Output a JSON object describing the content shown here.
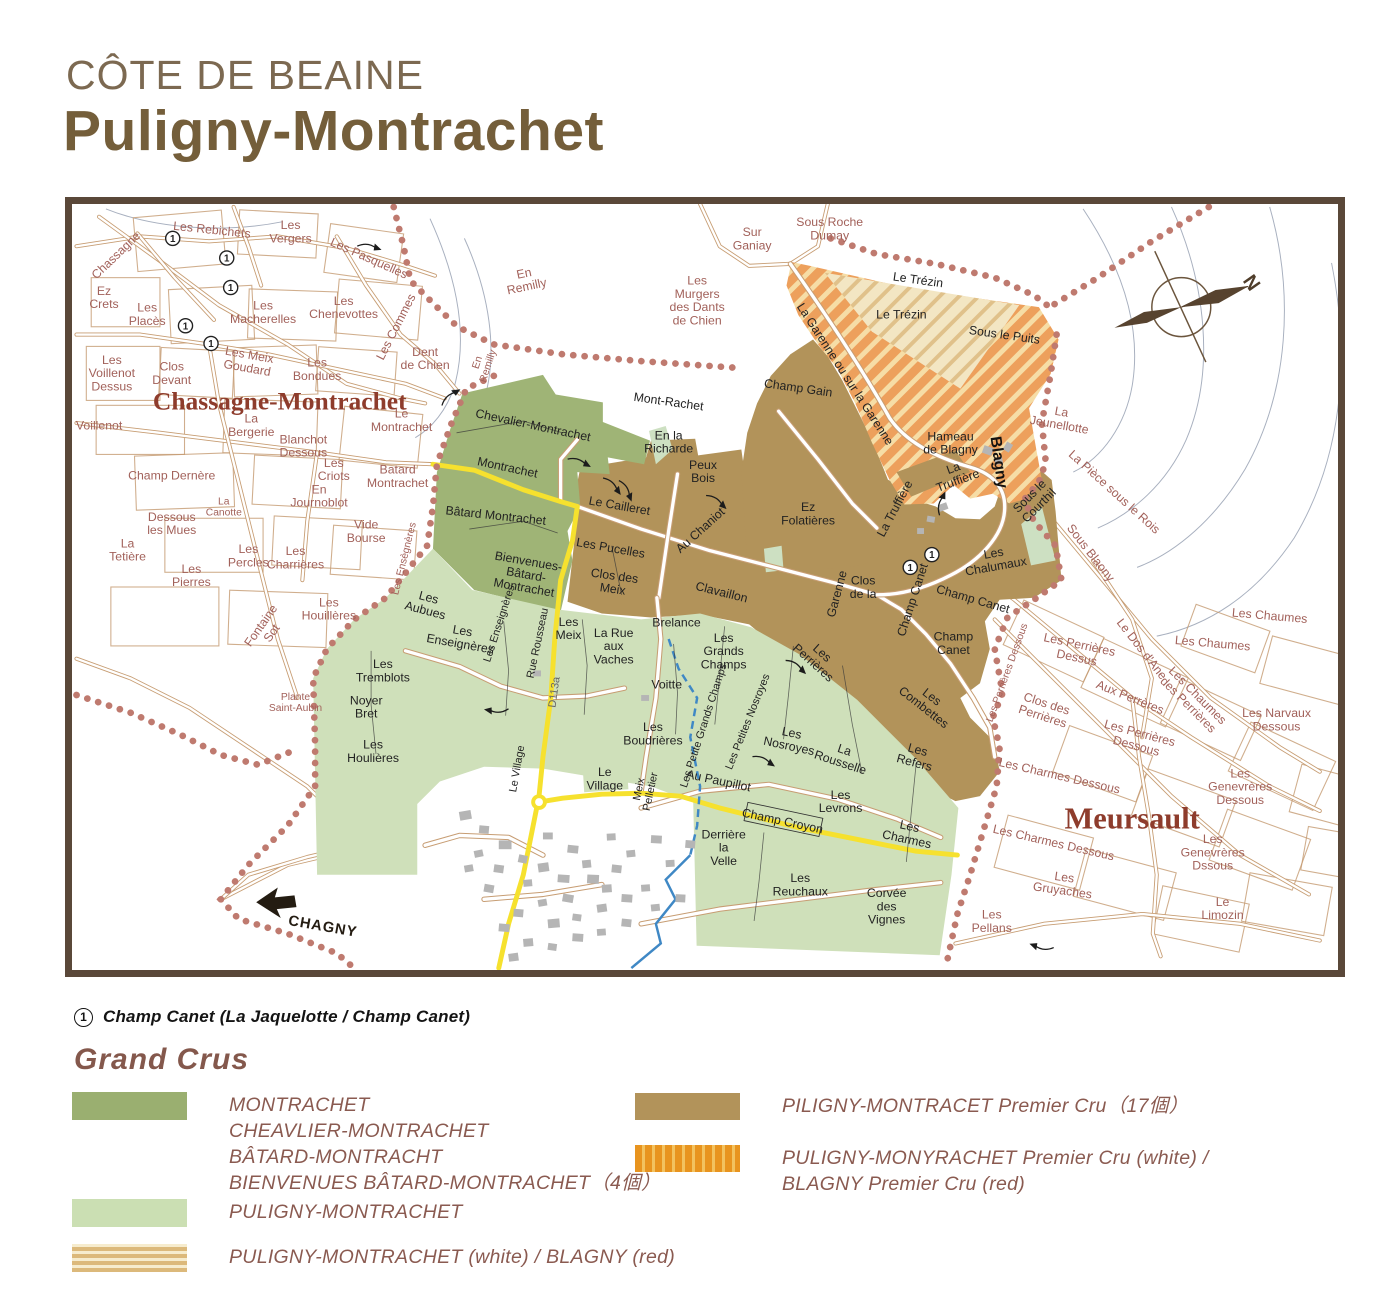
{
  "title": {
    "region": "CÔTE DE BEAINE",
    "name": "Puligny-Montrachet"
  },
  "footnote": {
    "marker": "1",
    "text": "Champ Canet (La Jaquelotte / Champ Canet)"
  },
  "legend": {
    "heading": "Grand Crus",
    "items_left": [
      {
        "swatch": "sw-grand-cru",
        "top": 1092,
        "lines": [
          "MONTRACHET",
          "CHEAVLIER-MONTRACHET",
          "BÂTARD-MONTRACHT",
          "BIENVENUES BÂTARD-MONTRACHET（4個）"
        ]
      },
      {
        "swatch": "sw-village",
        "top": 1199,
        "lines": [
          "PULIGNY-MONTRACHET"
        ]
      },
      {
        "swatch": "sw-stripe-h",
        "top": 1244,
        "lines": [
          "PULIGNY-MONTRACHET (white) / BLAGNY (red)"
        ]
      }
    ],
    "items_right": [
      {
        "swatch": "sw-premier-cru",
        "top": 1093,
        "lines": [
          "PILIGNY-MONTRACET Premier Cru（17個）"
        ]
      },
      {
        "swatch": "sw-stripe-v",
        "top": 1145,
        "lines": [
          "PULIGNY-MONYRACHET Premier Cru (white) /",
          "BLAGNY  Premier Cru (red)"
        ]
      }
    ]
  },
  "colors": {
    "grand_cru_green": "#9fb476",
    "village_green": "#cfe0ba",
    "premier_cru_brown": "#b2935a",
    "blagny_orange": "#eda05c",
    "trezin_cream": "#f3e6c3",
    "boundary_dots": "#bf7a6f",
    "road_tan": "#c79d73",
    "road_yellow": "#f6e12e",
    "stream_blue": "#3f88c5",
    "label_rose": "#a2615a",
    "label_maroon": "#8e3c2c",
    "title_brown": "#745e3a",
    "frame_brown": "#5a4839"
  },
  "map": {
    "compass_label": "N",
    "labels": [
      {
        "t": "Chassagne",
        "x": 40,
        "y": 52,
        "c": "rose",
        "r": -44
      },
      {
        "t": "Les Rebichets",
        "x": 138,
        "y": 26,
        "c": "rose",
        "r": 6
      },
      {
        "t": "Les\nVergers",
        "x": 218,
        "y": 28,
        "c": "rose"
      },
      {
        "t": "Les Pasquelles",
        "x": 298,
        "y": 55,
        "c": "rose",
        "r": 24
      },
      {
        "t": "Ez\nCrets",
        "x": 28,
        "y": 95,
        "c": "rose"
      },
      {
        "t": "Les\nPlacès",
        "x": 72,
        "y": 112,
        "c": "rose"
      },
      {
        "t": "Les\nMacherelles",
        "x": 190,
        "y": 110,
        "c": "rose"
      },
      {
        "t": "Les\nChenevottes",
        "x": 272,
        "y": 105,
        "c": "rose"
      },
      {
        "t": "Les Commes",
        "x": 325,
        "y": 125,
        "c": "rose",
        "r": -63
      },
      {
        "t": "Les\nVoillenot\nDessus",
        "x": 36,
        "y": 172,
        "c": "rose"
      },
      {
        "t": "Clos\nDevant",
        "x": 97,
        "y": 172,
        "c": "rose"
      },
      {
        "t": "Les  Meix\nGoudard",
        "x": 175,
        "y": 160,
        "c": "rose",
        "r": 10
      },
      {
        "t": "Les\nBondues",
        "x": 245,
        "y": 168,
        "c": "rose"
      },
      {
        "t": "Dent\nde Chien",
        "x": 355,
        "y": 157,
        "c": "rose"
      },
      {
        "t": "En\nRemilly",
        "x": 413,
        "y": 163,
        "c": "rose-sm",
        "r": -72
      },
      {
        "t": "En\nRemilly",
        "x": 457,
        "y": 77,
        "c": "rose",
        "r": -12
      },
      {
        "t": "Chassagne-Montrachet",
        "x": 207,
        "y": 200,
        "c": "big"
      },
      {
        "t": "Voillenot",
        "x": 23,
        "y": 225,
        "c": "rose"
      },
      {
        "t": "La\nBergerie",
        "x": 178,
        "y": 225,
        "c": "rose"
      },
      {
        "t": "Blanchot\nDessous",
        "x": 231,
        "y": 246,
        "c": "rose"
      },
      {
        "t": "Le\nMontrachet",
        "x": 331,
        "y": 220,
        "c": "rose"
      },
      {
        "t": "Champ Dernère",
        "x": 97,
        "y": 276,
        "c": "rose"
      },
      {
        "t": "Les\nCriots",
        "x": 262,
        "y": 270,
        "c": "rose"
      },
      {
        "t": "Batard\nMontrachet",
        "x": 327,
        "y": 277,
        "c": "rose"
      },
      {
        "t": "En\nJournoblot",
        "x": 247,
        "y": 297,
        "c": "rose"
      },
      {
        "t": "La\nCanotte",
        "x": 150,
        "y": 308,
        "c": "rose-sm"
      },
      {
        "t": "Dessous\nles Mues",
        "x": 97,
        "y": 325,
        "c": "rose"
      },
      {
        "t": "La\nTetière",
        "x": 52,
        "y": 352,
        "c": "rose"
      },
      {
        "t": "Les\nPercles",
        "x": 175,
        "y": 358,
        "c": "rose"
      },
      {
        "t": "Les\nCharrières",
        "x": 223,
        "y": 360,
        "c": "rose"
      },
      {
        "t": "Les\nPierres",
        "x": 117,
        "y": 378,
        "c": "rose"
      },
      {
        "t": "Vide\nBourse",
        "x": 295,
        "y": 333,
        "c": "rose"
      },
      {
        "t": "Les Ensègnères",
        "x": 333,
        "y": 361,
        "c": "rose-sm",
        "r": -76
      },
      {
        "t": "Fontaine\nSot",
        "x": 193,
        "y": 433,
        "c": "rose",
        "r": -55
      },
      {
        "t": "Les\nHouillères",
        "x": 257,
        "y": 412,
        "c": "rose"
      },
      {
        "t": "Plante\nSaint-Aubin",
        "x": 223,
        "y": 507,
        "c": "rose-sm"
      },
      {
        "t": "Sur\nGaniay",
        "x": 688,
        "y": 35,
        "c": "rose"
      },
      {
        "t": "Sous Roche\nDumay",
        "x": 767,
        "y": 25,
        "c": "rose"
      },
      {
        "t": "Les\nMurgers\ndes Dants\nde Chien",
        "x": 632,
        "y": 98,
        "c": "rose"
      },
      {
        "t": "La\nJeunellotte",
        "x": 1002,
        "y": 218,
        "c": "rose",
        "r": 10
      },
      {
        "t": "La Pièce sous le Rois",
        "x": 1057,
        "y": 293,
        "c": "rose",
        "r": 42
      },
      {
        "t": "Sous Blaony",
        "x": 1033,
        "y": 355,
        "c": "rose",
        "r": 52
      },
      {
        "t": "Les Chaumes",
        "x": 1157,
        "y": 447,
        "c": "rose",
        "r": 5
      },
      {
        "t": "Les Chaumes",
        "x": 1215,
        "y": 419,
        "c": "rose",
        "r": 5
      },
      {
        "t": "Les Narvaux\nDessous",
        "x": 1222,
        "y": 525,
        "c": "rose"
      },
      {
        "t": "Le Dos d'Ane",
        "x": 1085,
        "y": 453,
        "c": "rose",
        "r": 52
      },
      {
        "t": "Les Chaumes\ndes Perrières",
        "x": 1137,
        "y": 505,
        "c": "rose",
        "r": 45
      },
      {
        "t": "Aux Perrères",
        "x": 1073,
        "y": 502,
        "c": "rose",
        "r": 22
      },
      {
        "t": "Les Perrières\nDessus",
        "x": 1020,
        "y": 455,
        "c": "rose",
        "r": 12
      },
      {
        "t": "Clos des\nPerrières",
        "x": 986,
        "y": 515,
        "c": "rose",
        "r": 18
      },
      {
        "t": "Les Perrières\nDessous",
        "x": 1081,
        "y": 545,
        "c": "rose",
        "r": 15
      },
      {
        "t": "Les Perrières Dessous",
        "x": 947,
        "y": 477,
        "c": "rose-sm",
        "r": -70
      },
      {
        "t": "Les Charmes Dessous",
        "x": 1001,
        "y": 582,
        "c": "rose",
        "r": 13
      },
      {
        "t": "Les Charmes Dessous",
        "x": 995,
        "y": 650,
        "c": "rose",
        "r": 13
      },
      {
        "t": "Les\nGenevrères\nDessous",
        "x": 1185,
        "y": 593,
        "c": "rose"
      },
      {
        "t": "Les\nGenevrères\nDssous",
        "x": 1157,
        "y": 660,
        "c": "rose"
      },
      {
        "t": "Les\nGruyaches",
        "x": 1005,
        "y": 692,
        "c": "rose",
        "r": 8
      },
      {
        "t": "Le\nLimozin",
        "x": 1167,
        "y": 717,
        "c": "rose"
      },
      {
        "t": "Les\nPellans",
        "x": 932,
        "y": 730,
        "c": "rose"
      },
      {
        "t": "Meursault",
        "x": 1075,
        "y": 625,
        "c": "big2"
      },
      {
        "t": "Chevalier-Montrachet",
        "x": 465,
        "y": 225,
        "c": "dark",
        "r": 12
      },
      {
        "t": "Montrachet",
        "x": 439,
        "y": 268,
        "c": "dark",
        "r": 12
      },
      {
        "t": "Bâtard Montrachet",
        "x": 427,
        "y": 317,
        "c": "dark",
        "r": 6
      },
      {
        "t": "Bienvenues-\nBâtard-\nMontrachet",
        "x": 458,
        "y": 377,
        "c": "dark",
        "r": 10
      },
      {
        "t": "Mont-Rachet",
        "x": 603,
        "y": 201,
        "c": "dark",
        "r": 8
      },
      {
        "t": "En la\nRicharde",
        "x": 603,
        "y": 242,
        "c": "dark"
      },
      {
        "t": "Peux\nBois",
        "x": 638,
        "y": 272,
        "c": "dark"
      },
      {
        "t": "Le Cailleret",
        "x": 553,
        "y": 307,
        "c": "dark",
        "r": 10
      },
      {
        "t": "Au Chaniot",
        "x": 635,
        "y": 332,
        "c": "dark",
        "r": -42
      },
      {
        "t": "Ez\nFolatières",
        "x": 745,
        "y": 315,
        "c": "dark"
      },
      {
        "t": "Champ Gain",
        "x": 735,
        "y": 187,
        "c": "dark",
        "r": 8
      },
      {
        "t": "La Garenne ou sur la Garenne",
        "x": 783,
        "y": 173,
        "c": "dark",
        "r": 57
      },
      {
        "t": "Le Trézin",
        "x": 857,
        "y": 77,
        "c": "dark",
        "r": 8
      },
      {
        "t": "Le Trézin",
        "x": 840,
        "y": 112,
        "c": "dark"
      },
      {
        "t": "Sous le Puits",
        "x": 945,
        "y": 133,
        "c": "dark",
        "r": 8
      },
      {
        "t": "Hameau\nde Blagny",
        "x": 890,
        "y": 243,
        "c": "dark"
      },
      {
        "t": "Blagny",
        "x": 940,
        "y": 263,
        "c": "bold",
        "r": 82
      },
      {
        "t": "La\nTruffière",
        "x": 895,
        "y": 275,
        "c": "dark",
        "r": -20
      },
      {
        "t": "La Truffière",
        "x": 833,
        "y": 310,
        "c": "dark",
        "r": -62
      },
      {
        "t": "Sous le\nCourthil",
        "x": 975,
        "y": 302,
        "c": "dark",
        "r": -45
      },
      {
        "t": "Les\nChalumaux",
        "x": 935,
        "y": 362,
        "c": "dark",
        "r": -10
      },
      {
        "t": "Les Pucelles",
        "x": 544,
        "y": 350,
        "c": "dark",
        "r": 10
      },
      {
        "t": "Clos des\nMeix",
        "x": 547,
        "y": 385,
        "c": "dark",
        "r": 8
      },
      {
        "t": "Clavaillon",
        "x": 657,
        "y": 395,
        "c": "dark",
        "r": 14
      },
      {
        "t": "Garenne",
        "x": 774,
        "y": 397,
        "c": "dark",
        "r": -75
      },
      {
        "t": "Clos\nde la",
        "x": 801,
        "y": 390,
        "c": "dark"
      },
      {
        "t": "Champ Canet",
        "x": 851,
        "y": 403,
        "c": "dark",
        "r": -72
      },
      {
        "t": "Champ Canet",
        "x": 913,
        "y": 402,
        "c": "dark",
        "r": 16
      },
      {
        "t": "Champ\nCanet",
        "x": 893,
        "y": 447,
        "c": "dark"
      },
      {
        "t": "Les\nPerrières",
        "x": 755,
        "y": 462,
        "c": "dark",
        "r": 42
      },
      {
        "t": "Les\nCombettes",
        "x": 867,
        "y": 507,
        "c": "dark",
        "r": 38
      },
      {
        "t": "Les\nRefers",
        "x": 855,
        "y": 562,
        "c": "dark",
        "r": 15
      },
      {
        "t": "Les\nAubues",
        "x": 357,
        "y": 407,
        "c": "dark",
        "r": 15
      },
      {
        "t": "Les\nEnseignères",
        "x": 392,
        "y": 441,
        "c": "dark",
        "r": 10
      },
      {
        "t": "Les Enseignères",
        "x": 430,
        "y": 427,
        "c": "dark-sm",
        "r": -72
      },
      {
        "t": "Les\nTremblots",
        "x": 312,
        "y": 475,
        "c": "dark"
      },
      {
        "t": "Noyer\nBret",
        "x": 295,
        "y": 512,
        "c": "dark"
      },
      {
        "t": "Les\nHoulières",
        "x": 302,
        "y": 557,
        "c": "dark"
      },
      {
        "t": "Rue Rousseau",
        "x": 469,
        "y": 447,
        "c": "dark-sm",
        "r": -78
      },
      {
        "t": "D113a",
        "x": 486,
        "y": 497,
        "c": "gray",
        "r": -82
      },
      {
        "t": "Les\nMeix",
        "x": 501,
        "y": 432,
        "c": "dark"
      },
      {
        "t": "La Rue\naux\nVaches",
        "x": 547,
        "y": 450,
        "c": "dark"
      },
      {
        "t": "Brelance",
        "x": 611,
        "y": 426,
        "c": "dark"
      },
      {
        "t": "Voitte",
        "x": 601,
        "y": 489,
        "c": "dark"
      },
      {
        "t": "Les\nGrands\nChamps",
        "x": 659,
        "y": 455,
        "c": "dark"
      },
      {
        "t": "Les Petite Grands Champs",
        "x": 638,
        "y": 531,
        "c": "dark-sm",
        "r": -72
      },
      {
        "t": "Les\nBoudrières",
        "x": 587,
        "y": 539,
        "c": "dark"
      },
      {
        "t": "Les Petites Nosroyes",
        "x": 683,
        "y": 527,
        "c": "dark-sm",
        "r": -68
      },
      {
        "t": "Les\nNosroyes",
        "x": 727,
        "y": 545,
        "c": "dark",
        "r": 12
      },
      {
        "t": "La\nRousselle",
        "x": 780,
        "y": 562,
        "c": "dark",
        "r": 18
      },
      {
        "t": "Les\nLevrons",
        "x": 778,
        "y": 608,
        "c": "dark"
      },
      {
        "t": "Les\nCharmes",
        "x": 847,
        "y": 640,
        "c": "dark",
        "r": 12
      },
      {
        "t": "Les\nReuchaux",
        "x": 737,
        "y": 693,
        "c": "dark"
      },
      {
        "t": "Corvée\ndes\nVignes",
        "x": 825,
        "y": 715,
        "c": "dark"
      },
      {
        "t": "Derrière\nla\nVelle",
        "x": 659,
        "y": 655,
        "c": "dark"
      },
      {
        "t": "Au Paupillot",
        "x": 654,
        "y": 587,
        "c": "dark",
        "r": 12
      },
      {
        "t": "Champ Croyon",
        "x": 719,
        "y": 628,
        "c": "dark",
        "r": 12
      },
      {
        "t": "Meix\nPelletier",
        "x": 578,
        "y": 597,
        "c": "dark-sm",
        "r": -78
      },
      {
        "t": "Le Village",
        "x": 448,
        "y": 575,
        "c": "dark-sm",
        "r": -80
      },
      {
        "t": "Le\nVillage",
        "x": 538,
        "y": 585,
        "c": "dark"
      },
      {
        "t": "CHAGNY",
        "x": 251,
        "y": 735,
        "c": "chagny",
        "r": 10
      },
      {
        "t": "N",
        "x": 1197,
        "y": 80,
        "c": "compass",
        "r": 55
      }
    ],
    "markers": [
      {
        "x": 98,
        "y": 35
      },
      {
        "x": 153,
        "y": 55
      },
      {
        "x": 157,
        "y": 85
      },
      {
        "x": 111,
        "y": 124
      },
      {
        "x": 137,
        "y": 142
      },
      {
        "x": 871,
        "y": 357
      },
      {
        "x": 849,
        "y": 370
      }
    ]
  }
}
